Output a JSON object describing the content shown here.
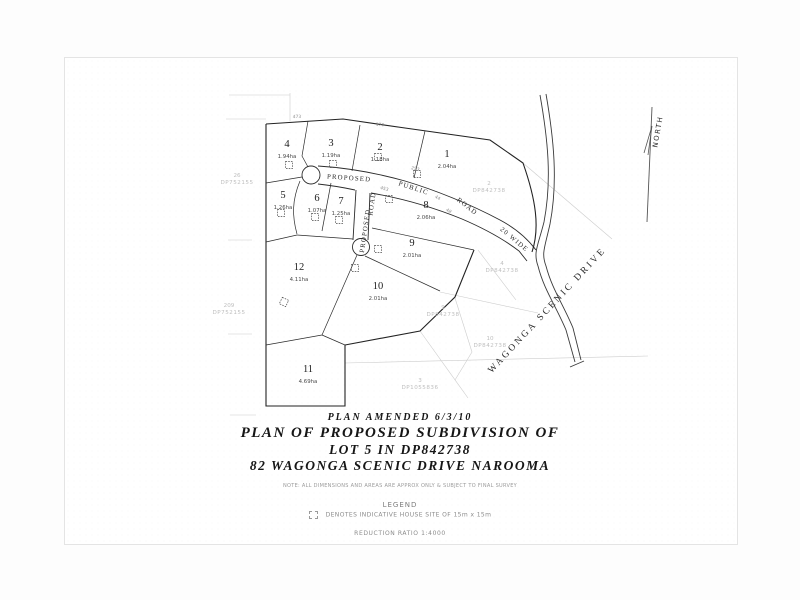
{
  "title_block": {
    "amended": "PLAN AMENDED 6/3/10",
    "line1": "PLAN OF PROPOSED SUBDIVISION OF",
    "line2": "LOT 5 IN DP842738",
    "line3": "82 WAGONGA SCENIC DRIVE NAROOMA",
    "note": "NOTE:  ALL DIMENSIONS AND AREAS ARE APPROX ONLY & SUBJECT TO FINAL SURVEY"
  },
  "legend": {
    "heading": "LEGEND",
    "item": "DENOTES INDICATIVE HOUSE SITE OF 15m x 15m",
    "ratio": "REDUCTION RATIO 1:4000"
  },
  "north": {
    "label": "NORTH",
    "x": 660,
    "y": 132,
    "rot": -80
  },
  "street": {
    "label": "WAGONGA SCENIC DRIVE",
    "x": 549,
    "y": 312,
    "rot": -47
  },
  "lots": [
    {
      "number": "1",
      "area": "2.04ha",
      "label": [
        447,
        157
      ],
      "house": [
        417,
        174
      ]
    },
    {
      "number": "2",
      "area": "1.18ha",
      "label": [
        380,
        150
      ],
      "house": [
        378,
        157
      ]
    },
    {
      "number": "3",
      "area": "1.19ha",
      "label": [
        331,
        146
      ],
      "house": [
        333,
        164
      ]
    },
    {
      "number": "4",
      "area": "1.94ha",
      "label": [
        287,
        147
      ],
      "house": [
        289,
        165
      ]
    },
    {
      "number": "5",
      "area": "1.26ha",
      "label": [
        283,
        198
      ],
      "house": [
        281,
        213
      ]
    },
    {
      "number": "6",
      "area": "1.07ha",
      "label": [
        317,
        201
      ],
      "house": [
        315,
        217
      ]
    },
    {
      "number": "7",
      "area": "1.25ha",
      "label": [
        341,
        204
      ],
      "house": [
        339,
        220
      ]
    },
    {
      "number": "8",
      "area": "2.06ha",
      "label": [
        426,
        208
      ],
      "house": [
        389,
        199
      ]
    },
    {
      "number": "9",
      "area": "2.01ha",
      "label": [
        412,
        246
      ],
      "house": [
        378,
        249
      ]
    },
    {
      "number": "10",
      "area": "2.01ha",
      "label": [
        378,
        289
      ],
      "house": [
        355,
        268
      ]
    },
    {
      "number": "11",
      "area": "4.69ha",
      "label": [
        308,
        372
      ],
      "house": null
    },
    {
      "number": "12",
      "area": "4.11ha",
      "label": [
        299,
        270
      ],
      "house": [
        284,
        302
      ],
      "house_rot": 25
    }
  ],
  "road_labels": [
    {
      "text": "PROPOSED",
      "x": 349,
      "y": 180,
      "rot": 4
    },
    {
      "text": "PUBLIC",
      "x": 413,
      "y": 190,
      "rot": 18
    },
    {
      "text": "ROAD",
      "x": 466,
      "y": 208,
      "rot": 38
    },
    {
      "text": "20 WIDE",
      "x": 513,
      "y": 241,
      "rot": 40
    },
    {
      "text": "ROAD",
      "x": 374,
      "y": 204,
      "rot": -82
    },
    {
      "text": "PROPOSED",
      "x": 367,
      "y": 231,
      "rot": -82
    }
  ],
  "dimensions": [
    {
      "t": "473",
      "x": 297,
      "y": 118,
      "r": -2
    },
    {
      "t": "170",
      "x": 380,
      "y": 126,
      "r": 4
    },
    {
      "t": "253",
      "x": 415,
      "y": 170,
      "r": 14
    },
    {
      "t": "453",
      "x": 384,
      "y": 190,
      "r": 16
    },
    {
      "t": "44",
      "x": 437,
      "y": 199,
      "r": 28
    },
    {
      "t": "48",
      "x": 448,
      "y": 212,
      "r": 32
    }
  ],
  "adjacent_parcels": [
    {
      "lot": "26",
      "dp": "DP752155",
      "x": 237,
      "y": 177
    },
    {
      "lot": "209",
      "dp": "DP752155",
      "x": 229,
      "y": 307
    },
    {
      "lot": "2",
      "dp": "DP842738",
      "x": 489,
      "y": 185
    },
    {
      "lot": "4",
      "dp": "DP842738",
      "x": 502,
      "y": 265
    },
    {
      "lot": "9",
      "dp": "DP842738",
      "x": 443,
      "y": 309
    },
    {
      "lot": "10",
      "dp": "DP842738",
      "x": 490,
      "y": 340
    },
    {
      "lot": "3",
      "dp": "DP1055836",
      "x": 420,
      "y": 382
    }
  ],
  "colors": {
    "boundary": "#2b2b2b",
    "faint_parcel": "#c9c9c9",
    "dim_text": "#8f8f8f",
    "paper": "#ffffff"
  }
}
